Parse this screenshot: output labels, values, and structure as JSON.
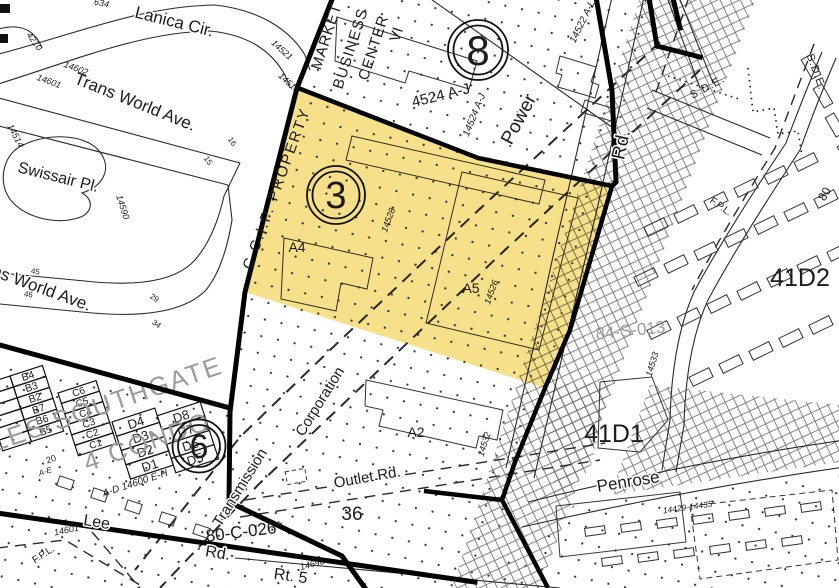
{
  "streets": {
    "lanica": "Lanica Cir.",
    "trans_world_1": "Trans World Ave.",
    "trans_world_2": "Trans World Ave.",
    "swissair": "Swissair Pl.",
    "power": "Power",
    "power_rd": "Rd.",
    "outlet_rd": "Outlet Rd.",
    "penrose": "Penrose",
    "lee": "Lee",
    "lee_rd": "Rd.",
    "rt5": "Rt. 5"
  },
  "areas": {
    "market_l1": "MARKET",
    "market_l2": "BUSINESS",
    "market_l3": "CENTER",
    "market_l4": "VI",
    "ccip": "C.C.I.P. PROPERTY",
    "southgate1": "LES SOUTHGATE",
    "southgate2": "4 CONDO",
    "zone_41d2": "41D2",
    "zone_41d1": "41D1"
  },
  "parcels": {
    "p4524": "4524 A-J",
    "p14524": "14524 A-J",
    "p14522": "14522 A-L",
    "a4": "A4",
    "a5": "A5",
    "a2": "A2",
    "n36": "36",
    "case_84": "84-S-013",
    "case_80": "80-C-026*",
    "range_14600": "A-D 14600 E-H",
    "range_14429": "14429-14435"
  },
  "easements": {
    "sde_a": "S.D.E.",
    "sde_b": "S.D.E.",
    "fpl_a": "F.P.L.",
    "fpl_b": "F.P.L.",
    "transmission": "Transmission",
    "corporation": "Corporation"
  },
  "circles": {
    "c8": "8",
    "c3": "3",
    "c6": "6"
  },
  "numbers": {
    "n634": "634",
    "n4210": "4210",
    "n14602": "14602",
    "n14601a": "14601",
    "n14514": "14514",
    "n14521": "14521",
    "n14518": "14518",
    "n16": "16",
    "n15": "15",
    "n14590": "14590",
    "n45": "45",
    "n46": "46",
    "n29": "29",
    "n34": "34",
    "n14528": "14528",
    "n14526": "14526",
    "n14532": "14532",
    "n14533": "14533",
    "n14690": "14690",
    "n14601b": "14601",
    "n20": "20",
    "nAE": "A-E",
    "n80": "80"
  },
  "tables": {
    "b": [
      "B4",
      "B3",
      "B2",
      "B7",
      "B6",
      "B5"
    ],
    "c": [
      "C6",
      "C5",
      "C4",
      "C3",
      "C2",
      "C1"
    ],
    "d_left": [
      "D4",
      "D3",
      "D2",
      "D1"
    ],
    "d_right": [
      "D8",
      "D7",
      "D6",
      "D5"
    ]
  },
  "colors": {
    "highlight": "#F5DB75",
    "highlight_border": "#8C7A1C",
    "gray_text": "#9B9B9B"
  }
}
